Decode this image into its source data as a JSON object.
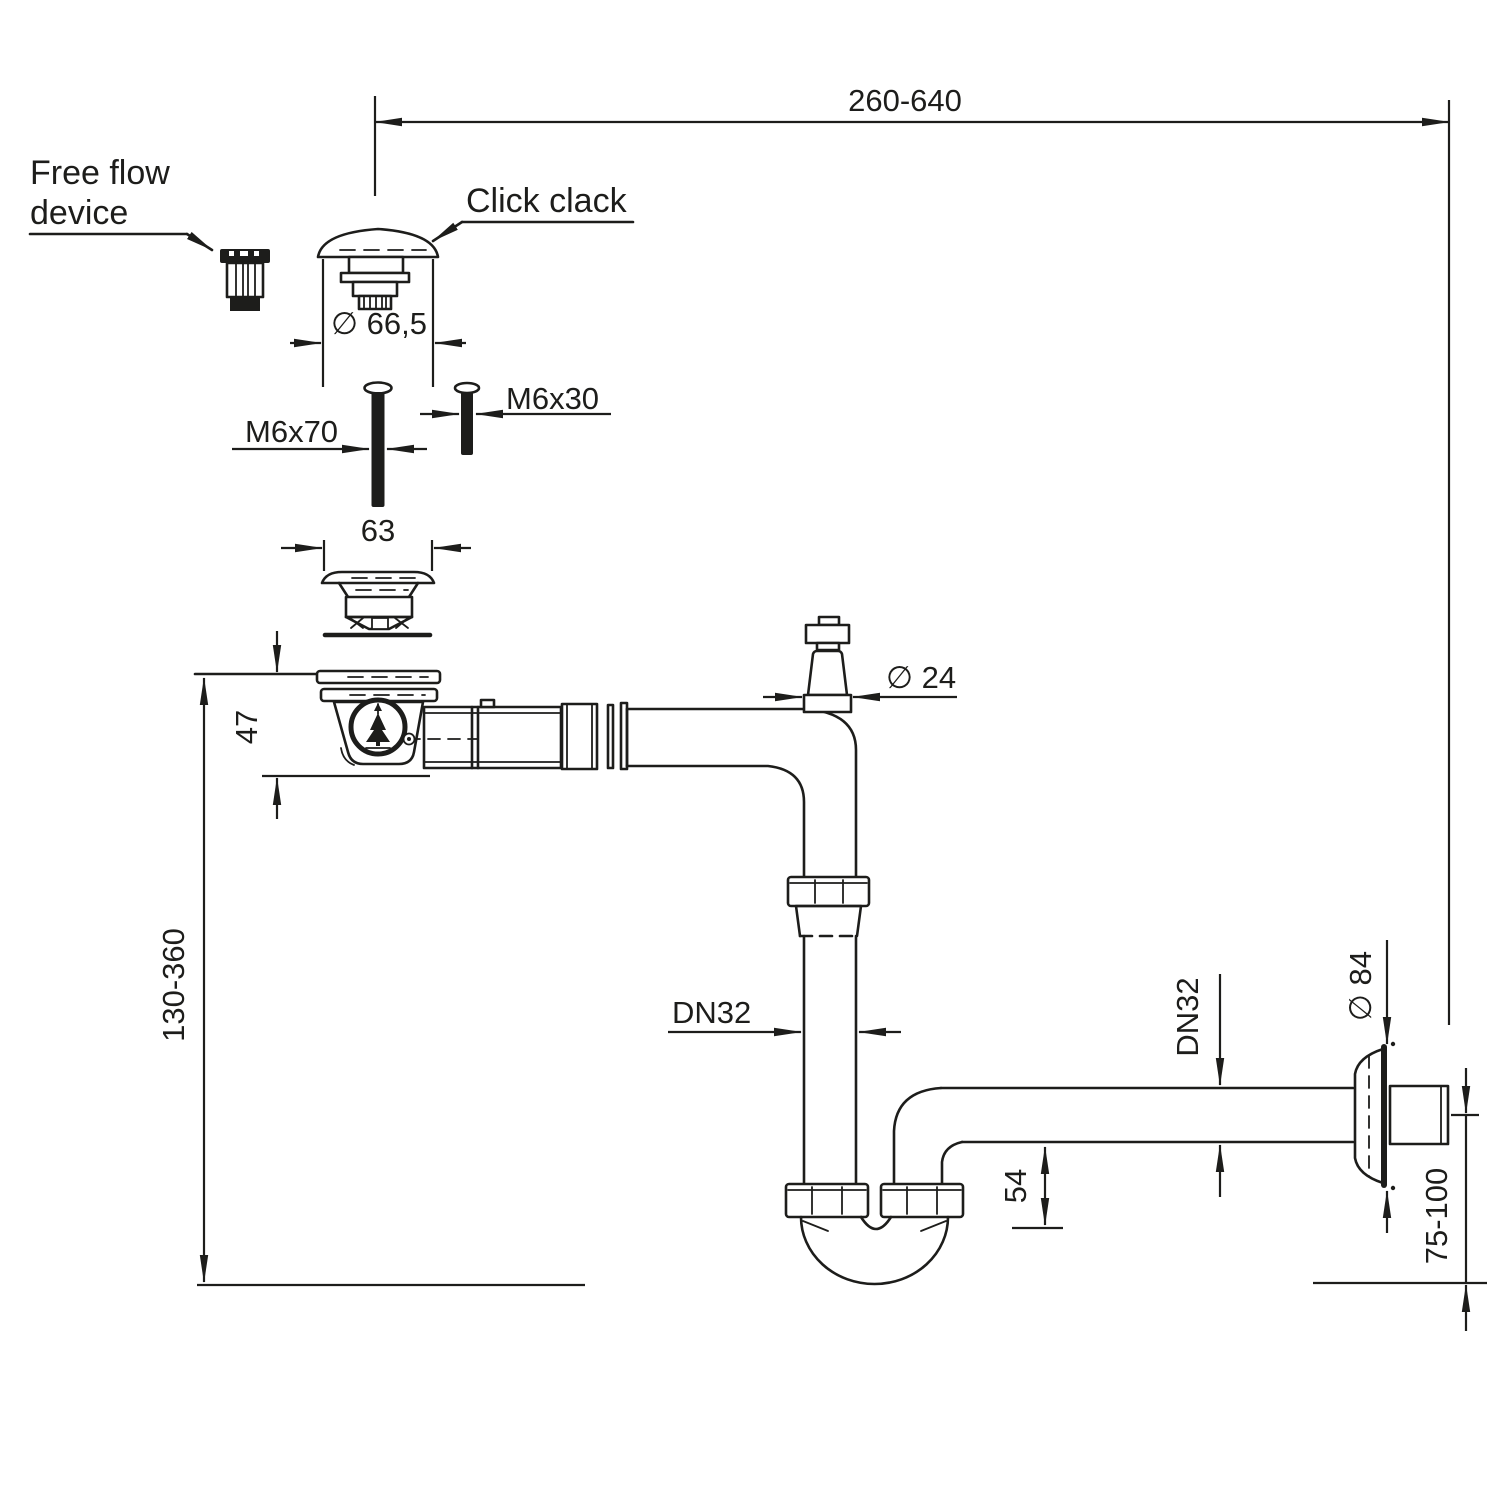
{
  "drawing": {
    "type": "technical-dimension-drawing",
    "subject": "sink drain siphon space-saving trap assembly",
    "colors": {
      "ink": "#1d1d1b",
      "paper": "#ffffff"
    },
    "labels": {
      "free_flow_1": "Free flow",
      "free_flow_2": "device",
      "click_clack": "Click clack"
    },
    "dims": {
      "top_span": "260-640",
      "cap_d": "∅ 66,5",
      "screw_long": "M6x70",
      "screw_short": "M6x30",
      "strainer_w": "63",
      "body_h": "47",
      "conn_d": "∅ 24",
      "height_range": "130-360",
      "dn_pipe": "DN32",
      "dn_wall": "DN32",
      "trap_h": "54",
      "rosette_d": "∅ 84",
      "wall_range": "75-100"
    }
  }
}
